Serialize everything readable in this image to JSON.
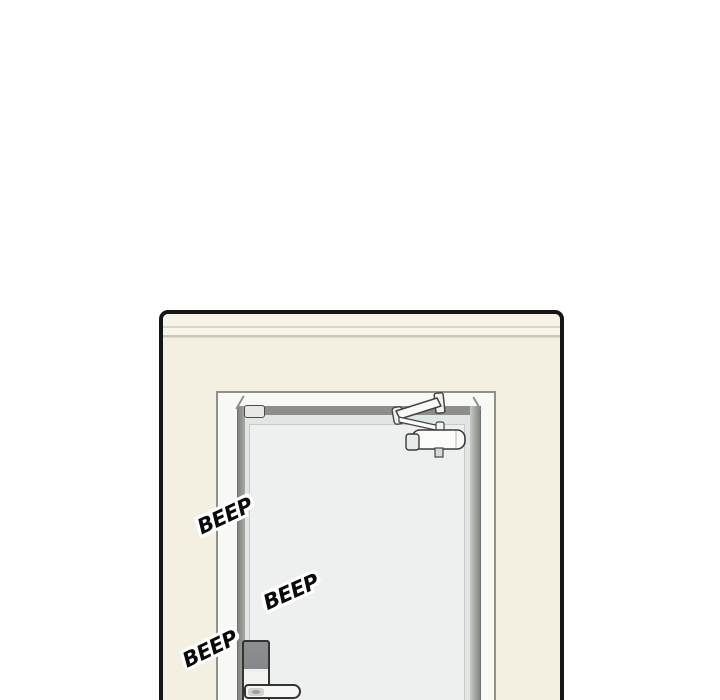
{
  "panel": {
    "type": "webtoon-comic-panel",
    "border_color": "#161616",
    "wall_color": "#f3efe1",
    "molding_color": "#f6f3e8"
  },
  "door": {
    "frame_color": "#f8f8f5",
    "recess_color": "#8b8e8a",
    "face_color": "#e1e5e3",
    "inset_panel_color": "#edf0ee",
    "hardware": [
      "door-closer",
      "hinge-stop",
      "electronic-lock",
      "lever-handle"
    ]
  },
  "lock": {
    "keypad_color": "#85878a",
    "body_color": "#f3f4f2",
    "outline_color": "#333333"
  },
  "sfx": {
    "color": "#0a0a0a",
    "outline_color": "#ffffff",
    "items": [
      {
        "text": "BEEP"
      },
      {
        "text": "BEEP"
      },
      {
        "text": "BEEP"
      }
    ]
  }
}
